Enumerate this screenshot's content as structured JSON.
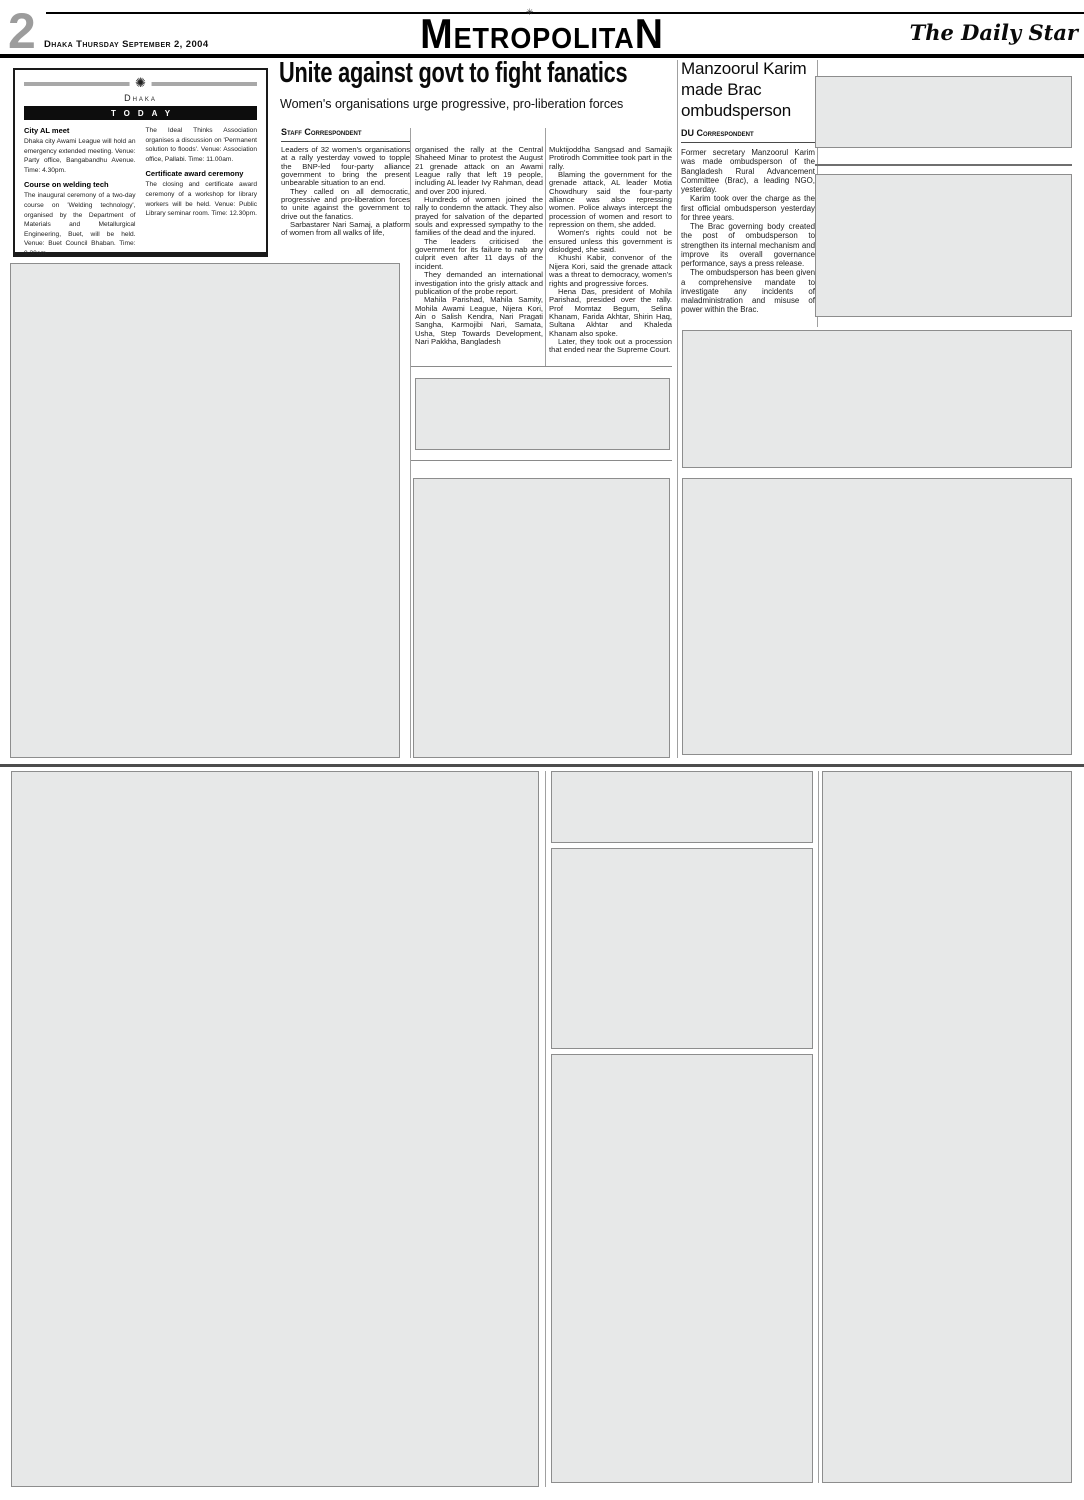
{
  "header": {
    "page_number": "2",
    "dateline": "Dhaka Thursday September 2, 2004",
    "section_title": "MetropolitaN",
    "masthead_ornament": "✳",
    "masthead": "The Daily Star"
  },
  "today_box": {
    "ornament": "✺",
    "kicker": "Dhaka",
    "banner": "TODAY",
    "left_items": [
      {
        "heading": "City AL meet",
        "body": "Dhaka city Awami League will hold an emergency extended meeting. Venue: Party office, Bangabandhu Avenue. Time: 4.30pm."
      },
      {
        "heading": "Course on welding tech",
        "body": "The inaugural ceremony of a two-day course on 'Welding technology', organised by the Department of Materials and Metallurgical Engineering, Buet, will be held. Venue: Buet Council Bhaban. Time: 9.30am."
      },
      {
        "heading": "Discussion",
        "body": ""
      }
    ],
    "right_items": [
      {
        "heading": "",
        "body": "The Ideal Thinks Association organises a discussion on 'Permanent solution to floods'. Venue: Association office, Pallabi. Time: 11.00am."
      },
      {
        "heading": "Certificate award ceremony",
        "body": "The closing and certificate award ceremony of a workshop for library workers will be held. Venue: Public Library seminar room. Time: 12.30pm."
      }
    ]
  },
  "lead_article": {
    "headline": "Unite against govt to fight fanatics",
    "subhead": "Women's organisations urge progressive, pro-liberation forces",
    "byline": "Staff Correspondent",
    "col1": [
      "Leaders of 32 women's organisations at a rally yesterday vowed to topple the BNP-led four-party alliance government to bring the present unbearable situation to an end.",
      "They called on all democratic, progressive and pro-liberation forces to unite against the government to drive out the fanatics.",
      "Sarbastarer Nari Samaj, a platform of women from all walks of life,"
    ],
    "col2": [
      "organised the rally at the Central Shaheed Minar to protest the August 21 grenade attack on an Awami League rally that left 19 people, including AL leader Ivy Rahman, dead and over 200 injured.",
      "Hundreds of women joined the rally to condemn the attack. They also prayed for salvation of the departed souls and expressed sympathy to the families of the dead and the injured.",
      "The leaders criticised the government for its failure to nab any culprit even after 11 days of the incident.",
      "They demanded an international investigation into the grisly attack and publication of the probe report.",
      "Mahila Parishad, Mahila Samity, Mohila Awami League, Nijera Kori, Ain o Salish Kendra, Nari Pragati Sangha, Karmojibi Nari, Samata, Usha, Step Towards Development, Nari Pakkha, Bangladesh"
    ],
    "col3": [
      "Muktijoddha Sangsad and Samajik Protirodh Committee took part in the rally.",
      "Blaming the government for the grenade attack, AL leader Motia Chowdhury said the four-party alliance was also repressing women. Police always intercept the procession of women and resort to repression on them, she added.",
      "Women's rights could not be ensured unless this government is dislodged, she said.",
      "Khushi Kabir, convenor of the Nijera Kori, said the grenade attack was a threat to democracy, women's rights and progressive forces.",
      "Hena Das, president of Mohila Parishad, presided over the rally. Prof Momtaz Begum, Selina Khanam, Farida Akhtar, Shirin Haq, Sultana Akhtar and Khaleda Khanam also spoke.",
      "Later, they took out a procession that ended near the Supreme Court."
    ]
  },
  "brac_article": {
    "headline": "Manzoorul Karim made Brac ombudsperson",
    "byline": "DU Correspondent",
    "paragraphs": [
      "Former secretary Manzoorul Karim was made ombudsperson of the Bangladesh Rural Advancement Committee (Brac), a leading NGO, yesterday.",
      "Karim took over the charge as the first official ombudsperson yesterday for three years.",
      "The Brac governing body created the post of ombudsperson to strengthen its internal mechanism and improve its overall governance performance, says a press release.",
      "The ombudsperson has been given a comprehensive mandate to investigate any incidents of maladministration and misuse of power within the Brac."
    ]
  },
  "colors": {
    "placeholder_fill": "#e7e8e8",
    "placeholder_border": "#8d8d8d",
    "ink": "#0a0a0a",
    "page_number_gray": "#9c9c9c"
  }
}
